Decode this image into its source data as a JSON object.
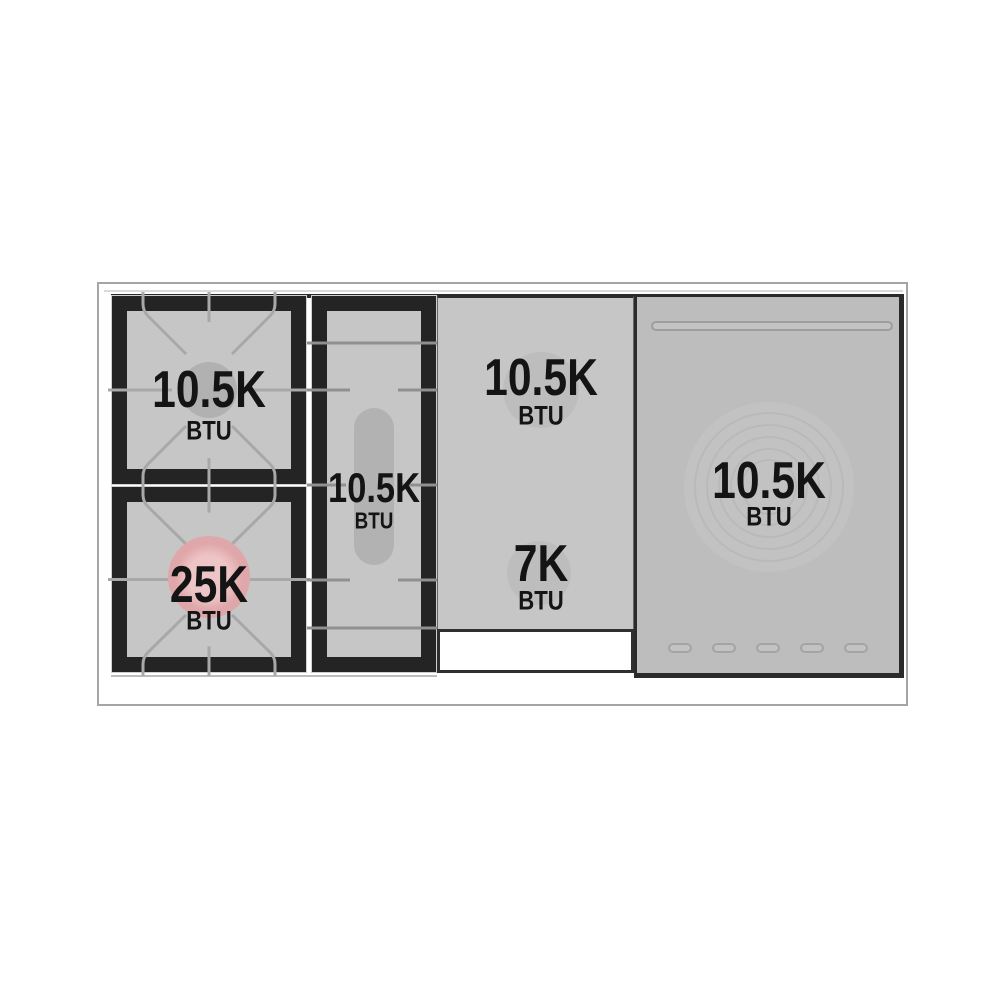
{
  "diagram": {
    "sections": {
      "left_rear_burner": {
        "value": "10.5K",
        "unit": "BTU"
      },
      "left_front_burner": {
        "value": "25K",
        "unit": "BTU"
      },
      "center_oval_burner": {
        "value": "10.5K",
        "unit": "BTU"
      },
      "griddle_rear_burner": {
        "value": "10.5K",
        "unit": "BTU"
      },
      "griddle_front_burner": {
        "value": "7K",
        "unit": "BTU"
      },
      "french_top_burner": {
        "value": "10.5K",
        "unit": "BTU"
      }
    },
    "colors": {
      "surface_gray": "#c6c6c6",
      "panel_gray": "#bdbdbd",
      "frame_black": "#242424",
      "highlight_pink": "#dfa7a9",
      "burner_gray": "#b1b1b1"
    }
  }
}
